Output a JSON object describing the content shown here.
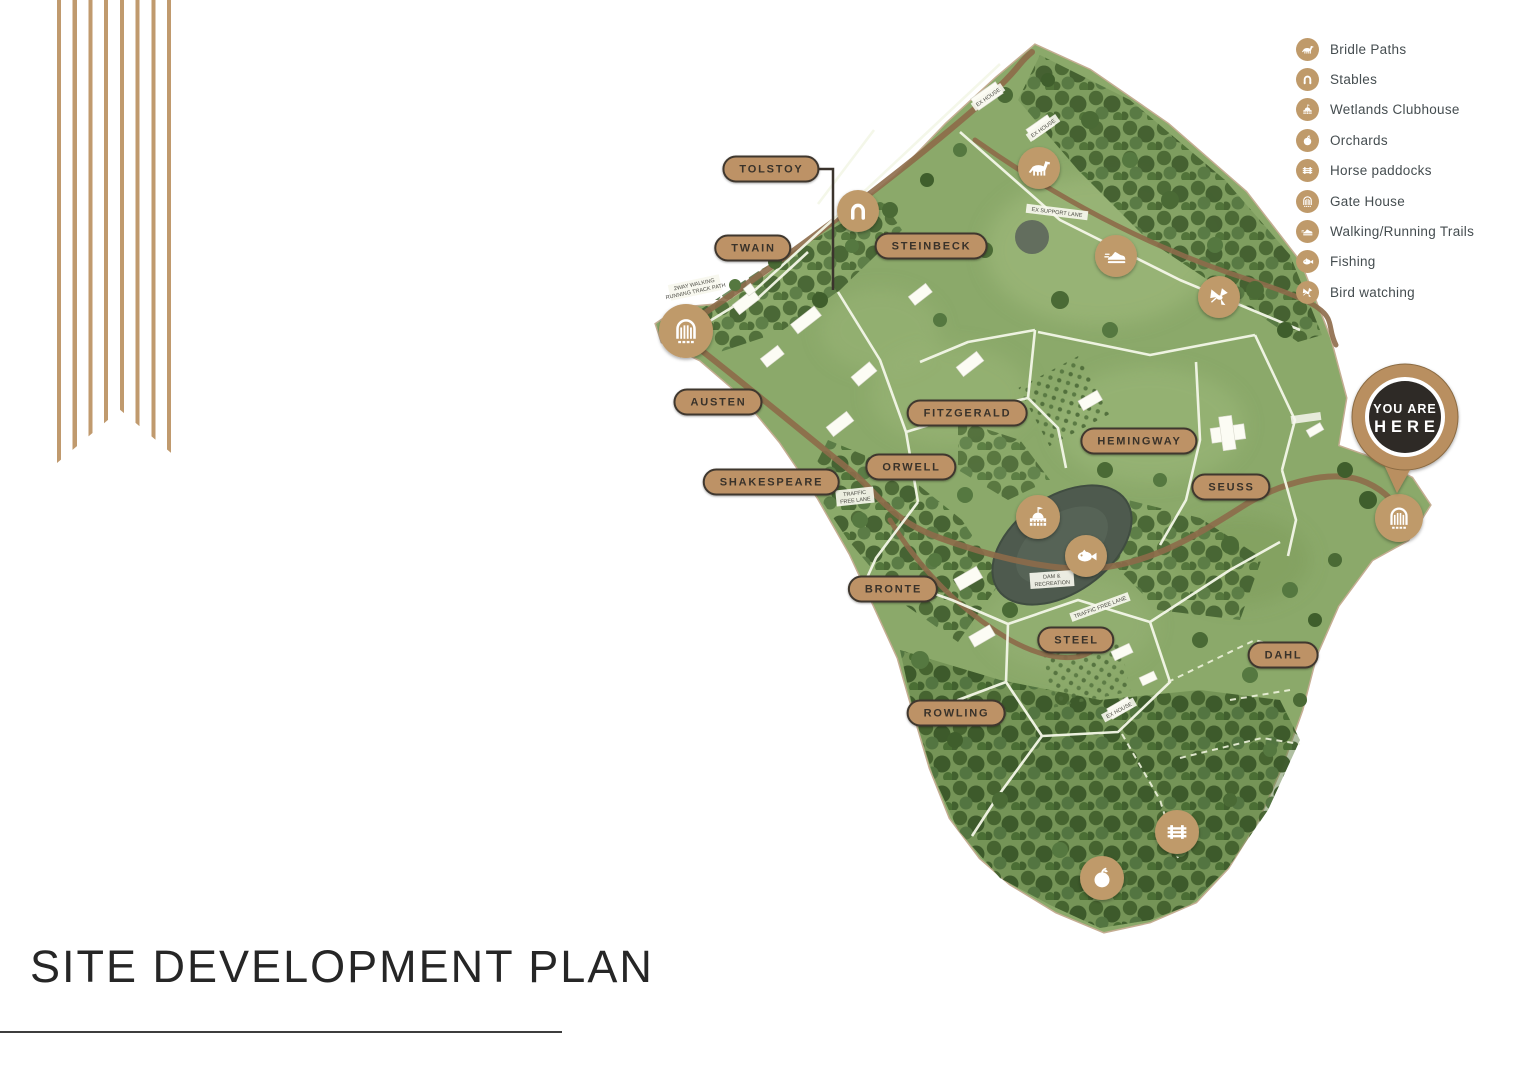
{
  "title": {
    "text": "SITE DEVELOPMENT PLAN"
  },
  "legend": {
    "items": [
      {
        "icon": "horse-icon",
        "label": "Bridle Paths"
      },
      {
        "icon": "horseshoe-icon",
        "label": "Stables"
      },
      {
        "icon": "clubhouse-icon",
        "label": "Wetlands Clubhouse"
      },
      {
        "icon": "apple-icon",
        "label": "Orchards"
      },
      {
        "icon": "paddock-icon",
        "label": "Horse paddocks"
      },
      {
        "icon": "gate-icon",
        "label": "Gate House"
      },
      {
        "icon": "shoe-icon",
        "label": "Walking/Running Trails"
      },
      {
        "icon": "fish-icon",
        "label": "Fishing"
      },
      {
        "icon": "bird-icon",
        "label": "Bird watching"
      }
    ]
  },
  "map": {
    "lots": {
      "tolstoy": "TOLSTOY",
      "twain": "TWAIN",
      "steinbeck": "STEINBECK",
      "austen": "AUSTEN",
      "fitzgerald": "FITZGERALD",
      "orwell": "ORWELL",
      "shakespeare": "SHAKESPEARE",
      "hemingway": "HEMINGWAY",
      "seuss": "SEUSS",
      "bronte": "BRONTE",
      "steel": "STEEL",
      "dahl": "DAHL",
      "rowling": "ROWLING"
    },
    "you_are_here": {
      "line1": "YOU ARE",
      "line2": "HERE"
    },
    "small_labels": {
      "ex_house_1": "EX HOUSE",
      "ex_house_2": "EX HOUSE",
      "ex_house_3": "EX HOUSE",
      "support_lane": "EX SUPPORT LANE",
      "track_path_a": "2WAY WALKING",
      "track_path_b": "RUNNING TRACK PATH",
      "traffic_1a": "TRAFFIC",
      "traffic_1b": "FREE LANE",
      "traffic_2": "TRAFFIC FREE LANE",
      "dam_a": "DAM &",
      "dam_b": "RECREATION"
    },
    "colors": {
      "accent_tan": "#bf9a6a",
      "pill_fill": "#bd9266",
      "pin_dark": "#2e2a26",
      "grass_green": "#8ba96a"
    }
  }
}
